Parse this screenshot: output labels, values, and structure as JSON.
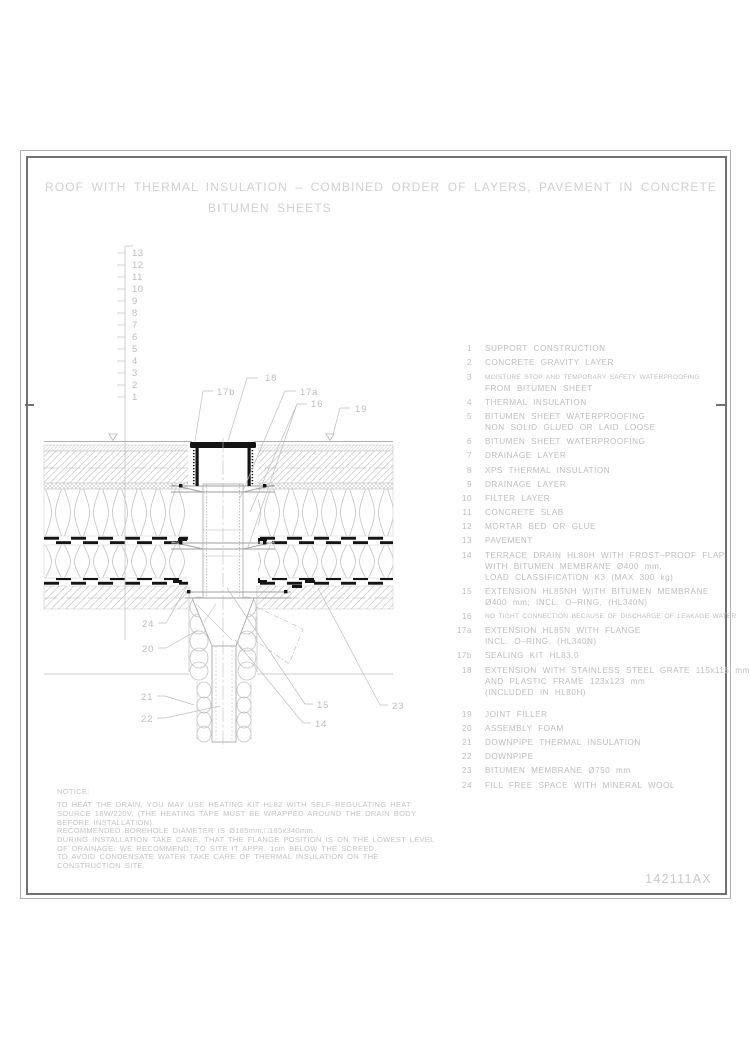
{
  "title": {
    "line1": "ROOF WITH THERMAL INSULATION – COMBINED ORDER OF LAYERS, PAVEMENT IN CONCRETE",
    "line2": "BITUMEN SHEETS"
  },
  "legend": {
    "rows": [
      {
        "num": "1",
        "text": "SUPPORT CONSTRUCTION"
      },
      {
        "num": "2",
        "text": "CONCRETE GRAVITY LAYER"
      },
      {
        "num": "3",
        "text": "MOISTURE STOP AND TEMPORARY SAFETY WATERPROOFING"
      },
      {
        "num": "",
        "text": "FROM BITUMEN SHEET"
      },
      {
        "num": "4",
        "text": "THERMAL INSULATION"
      },
      {
        "num": "5",
        "text": "BITUMEN SHEET WATERPROOFING"
      },
      {
        "num": "",
        "text": "NON SOLID GLUED OR LAID LOOSE"
      },
      {
        "num": "6",
        "text": "BITUMEN SHEET WATERPROOFING"
      },
      {
        "num": "7",
        "text": "DRAINAGE LAYER"
      },
      {
        "num": "8",
        "text": "XPS THERMAL INSULATION"
      },
      {
        "num": "9",
        "text": "DRAINAGE LAYER"
      },
      {
        "num": "10",
        "text": "FILTER LAYER"
      },
      {
        "num": "11",
        "text": "CONCRETE SLAB"
      },
      {
        "num": "12",
        "text": "MORTAR BED OR GLUE"
      },
      {
        "num": "13",
        "text": "PAVEMENT"
      },
      {
        "num": "14",
        "text": "TERRACE DRAIN HL80H WITH FROST–PROOF FLAP"
      },
      {
        "num": "",
        "text": "WITH BITUMEN MEMBRANE Ø400 mm,"
      },
      {
        "num": "",
        "text": "LOAD CLASSIFICATION K3 (MAX 300 kg)"
      },
      {
        "num": "15",
        "text": "EXTENSION HL85NH WITH BITUMEN MEMBRANE"
      },
      {
        "num": "",
        "text": "Ø400 mm; INCL. O–RING, (HL340N)"
      },
      {
        "num": "16",
        "text": "NO TIGHT CONNECTION BECAUSE OF DISCHARGE OF LEAKAGE WATER"
      },
      {
        "num": "17a",
        "text": "EXTENSION HL85N WITH FLANGE"
      },
      {
        "num": "",
        "text": "INCL. O–RING, (HL340N)"
      },
      {
        "num": "17b",
        "text": "SEALING KIT HL83.0"
      },
      {
        "num": "18",
        "text": "EXTENSION WITH STAINLESS STEEL GRATE 115x115 mm"
      },
      {
        "num": "",
        "text": "AND PLASTIC FRAME 123x123 mm"
      },
      {
        "num": "",
        "text": "(INCLUDED IN HL80H)"
      },
      {
        "num": "19",
        "text": "JOINT FILLER"
      },
      {
        "num": "20",
        "text": "ASSEMBLY FOAM"
      },
      {
        "num": "21",
        "text": "DOWNPIPE THERMAL INSULATION"
      },
      {
        "num": "22",
        "text": "DOWNPIPE"
      },
      {
        "num": "23",
        "text": "BITUMEN MEMBRANE Ø750 mm"
      },
      {
        "num": "24",
        "text": "FILL FREE SPACE WITH MINERAL WOOL"
      }
    ]
  },
  "scale": {
    "numbers": [
      "13",
      "12",
      "11",
      "10",
      "9",
      "8",
      "7",
      "6",
      "5",
      "4",
      "3",
      "2",
      "1"
    ]
  },
  "callouts": {
    "c18": "18",
    "c17b": "17b",
    "c17a": "17a",
    "c16": "16",
    "c19": "19",
    "c24": "24",
    "c20": "20",
    "c21": "21",
    "c22": "22",
    "c15": "15",
    "c14": "14",
    "c23": "23"
  },
  "notice": {
    "heading": "NOTICE:",
    "lines": [
      "TO HEAT THE DRAIN, YOU MAY USE HEATING KIT HL82 WITH SELF–REGULATING HEAT",
      "SOURCE 18W/220V. (THE HEATING TAPE MUST BE WRAPPED AROUND THE DRAIN BODY",
      "BEFORE INSTALLATION).",
      "RECOMMENDED BOREHOLE DIAMETER IS Ø185mm,□185x340mm.",
      "DURING INSTALLATION TAKE CARE, THAT THE FLANGE POSITION IS ON THE LOWEST LEVEL",
      "OF DRAINAGE. WE RECOMMEND, TO SITE IT APPR. 1cm BELOW THE SCREED.",
      "TO AVOID CONDENSATE WATER TAKE CARE OF THERMAL INSULATION ON THE",
      "CONSTRUCTION SITE."
    ]
  },
  "page": {
    "drawing_number": "142111AX"
  },
  "colors": {
    "line_gray": "#b8b8b8",
    "text_gray": "#bdbdbd",
    "ink_black": "#141414"
  }
}
